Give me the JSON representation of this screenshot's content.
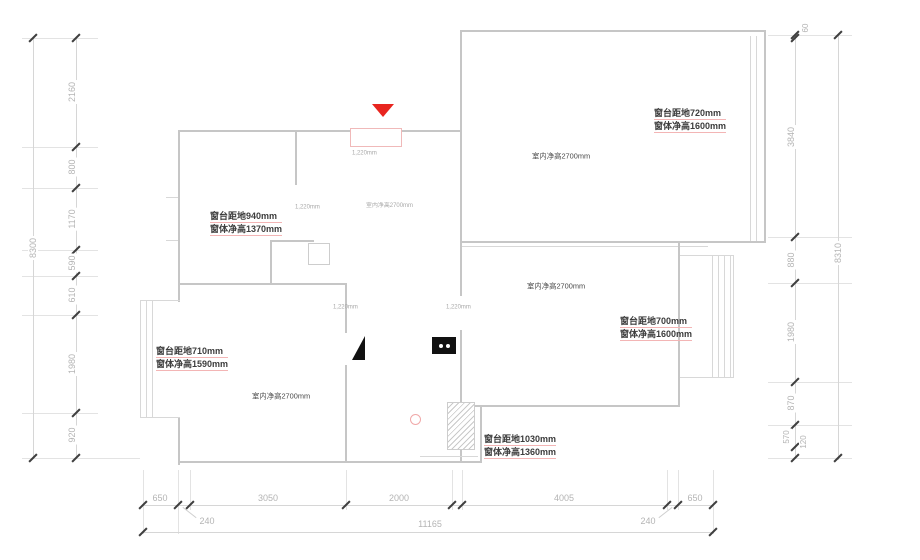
{
  "plan": {
    "ceiling_height_label": "室内净高2700mm",
    "opening_width_label": "1,220mm",
    "window_annotations": [
      {
        "line1": "窗台距地720mm",
        "line2": "窗体净高1600mm"
      },
      {
        "line1": "窗台距地940mm",
        "line2": "窗体净高1370mm"
      },
      {
        "line1": "窗台距地710mm",
        "line2": "窗体净高1590mm"
      },
      {
        "line1": "窗台距地700mm",
        "line2": "窗体净高1600mm"
      },
      {
        "line1": "窗台距地1030mm",
        "line2": "窗体净高1360mm"
      }
    ]
  },
  "dimensions": {
    "left_total": "8300",
    "left_segments": [
      "2160",
      "800",
      "1170",
      "590",
      "610",
      "1980",
      "920"
    ],
    "right_segments": [
      "60",
      "3840",
      "880",
      "1980",
      "870",
      "570",
      "120"
    ],
    "right_total": "8310",
    "bottom_segments": [
      "650",
      "240",
      "3050",
      "2000",
      "4005",
      "240",
      "650"
    ],
    "bottom_total": "11165"
  },
  "colors": {
    "wall": "#c6c6c6",
    "dimension_line": "#d6d6d6",
    "dimension_text": "#b4b4b4",
    "tick": "#3f3f3f",
    "annotation_text": "#3c3c3c",
    "annotation_underline": "#f3b5b5",
    "entry_marker_red": "#e8251f",
    "door_outline_pink": "#f0b9b9",
    "symbol_black": "#111111"
  }
}
